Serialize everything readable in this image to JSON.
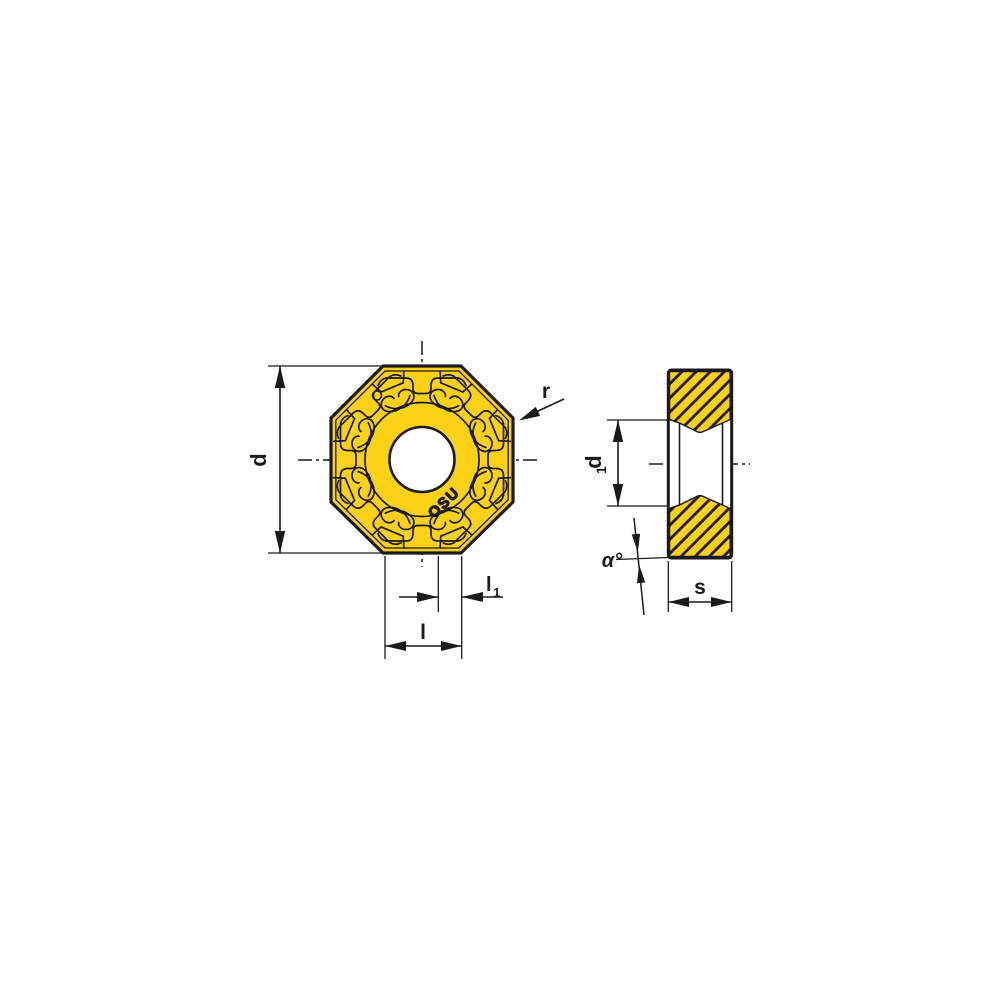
{
  "drawing": {
    "background_color": "#ffffff",
    "line_color": "#1a1a1a",
    "insert_color": "#fcd116",
    "marking": "OSU",
    "front_view": {
      "labels": {
        "diameter": "d",
        "corner_radius": "r",
        "edge_length": "l",
        "edge_length1_base": "l",
        "edge_length1_sub": "1"
      }
    },
    "side_view": {
      "labels": {
        "bore_base": "d",
        "bore_sub": "1",
        "thickness": "s",
        "clearance_angle": "α°"
      }
    }
  }
}
